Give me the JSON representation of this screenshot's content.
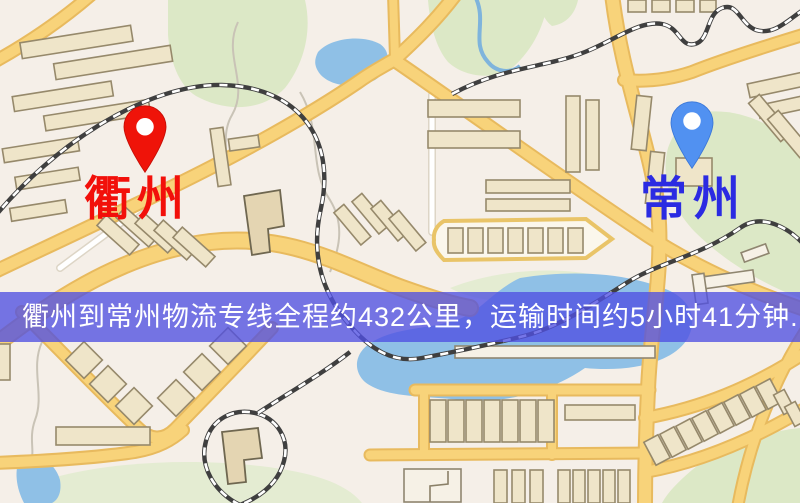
{
  "map": {
    "origin": {
      "label": "衢州",
      "label_color": "#f2100a",
      "marker": "red-pin"
    },
    "destination": {
      "label": "常州",
      "label_color": "#2b2be2",
      "marker": "blue-pin"
    },
    "banner": {
      "text": "衢州到常州物流专线全程约432公里，运输时间约5小时41分钟.",
      "bg_color": "#5050e1",
      "text_color": "#ffffff"
    },
    "palette": {
      "background": "#f5efe8",
      "road_fill": "#f8d37a",
      "road_casing": "#e8ba5e",
      "park_green": "#dce8c6",
      "water_blue": "#8fc0e6",
      "railway_dark": "#3f3f3f",
      "building_fill": "#efe5c9",
      "building_stroke": "#96896b",
      "red_pin": "#ef1309",
      "blue_pin": "#5191f1"
    }
  }
}
